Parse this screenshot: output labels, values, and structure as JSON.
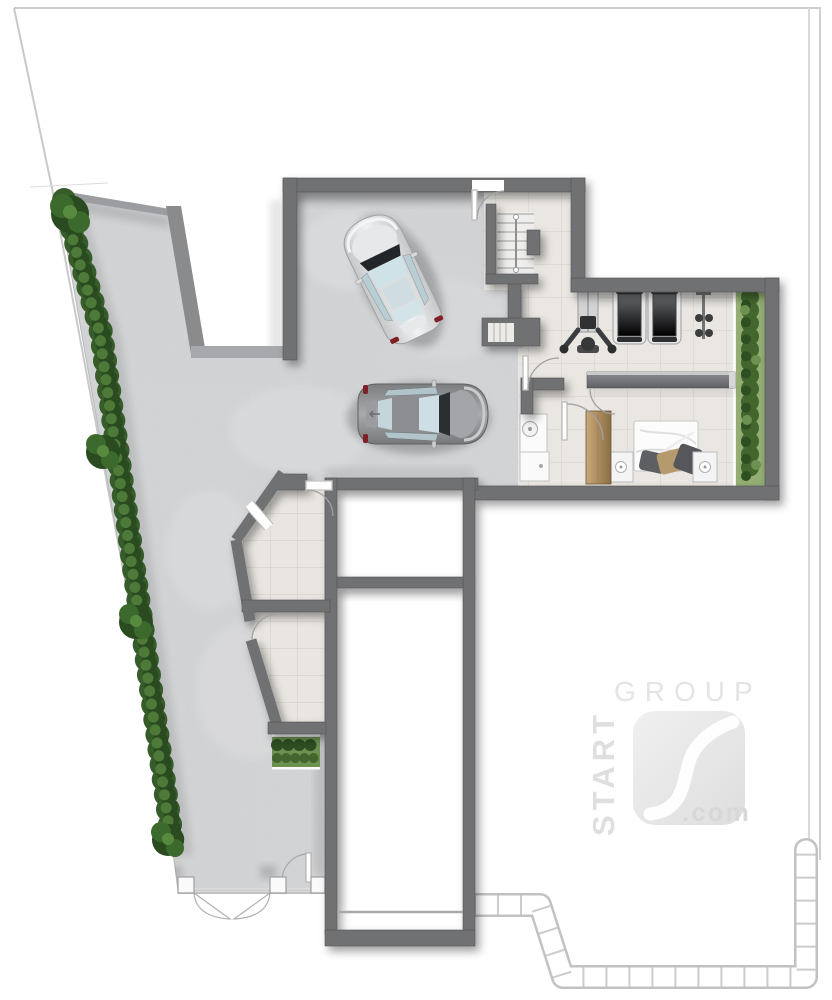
{
  "watermark": {
    "start": "START",
    "group": "GROUP",
    "com": ".com"
  },
  "palette": {
    "background": "#ffffff",
    "boundary_line": "#cccccc",
    "wall": "#6f7173",
    "concrete": "#d4d5d7",
    "tile": "#eae7e2",
    "tile_line": "#d8d4cd",
    "white_room": "#ffffff",
    "hedge_dark": "#2a4a20",
    "hedge_mid": "#3c6a2c",
    "hedge_light": "#578a3f",
    "garden_base": "#93ad72",
    "cabinet_wood": "#b3925f",
    "bed_linen": "#fbfbfb",
    "pillow_gray": "#5d5f62",
    "pillow_tan": "#b49a6d",
    "treadmill_belt": "#5e6063",
    "car_silver": "#e9eaeb",
    "car_gray": "#97999c",
    "glass": "#cfe2e7",
    "taillight": "#7e2026",
    "watermark_gray": "#e2e2e2"
  }
}
